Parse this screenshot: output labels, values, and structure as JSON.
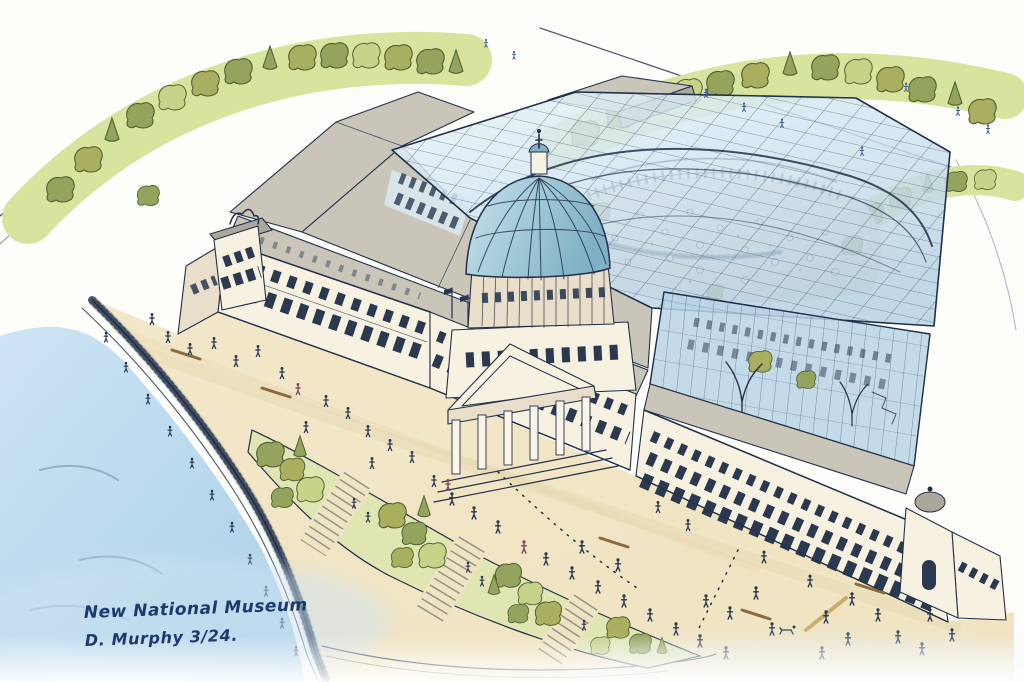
{
  "annotation": {
    "line1": "New National Museum",
    "line2": "D. Murphy 3/24."
  },
  "palette": {
    "paper": "#fdfdfa",
    "water": "#b7d8ee",
    "waterDeep": "#a3cbe7",
    "plaza": "#f2e7c9",
    "plazaShade": "#e2d1a9",
    "park": "#d8e49e",
    "treeLight": "#c6d389",
    "treeMid": "#94a45c",
    "treeOlive": "#aaae5f",
    "treeDark": "#4f6136",
    "wall": "#f7f1e1",
    "wallShade": "#e9deca",
    "window": "#2a3950",
    "roof": "#c9c5b9",
    "roofDark": "#aba79a",
    "glass": "#cfe4f0",
    "glassDeep": "#b9d4e6",
    "ink": "#22304a",
    "inkSoft": "#5a6a80",
    "courtyard": "#eddbd2",
    "domeLight": "#bedbe6",
    "domeDeep": "#83afc3",
    "figure": "#263552",
    "figureBlue": "#3c5f94",
    "figureMaroon": "#7c3f5e",
    "ramp": "#efe4c2",
    "bench": "#8a6a3c",
    "signature": "#1c3a6e",
    "wash": "#cfe3f3"
  }
}
